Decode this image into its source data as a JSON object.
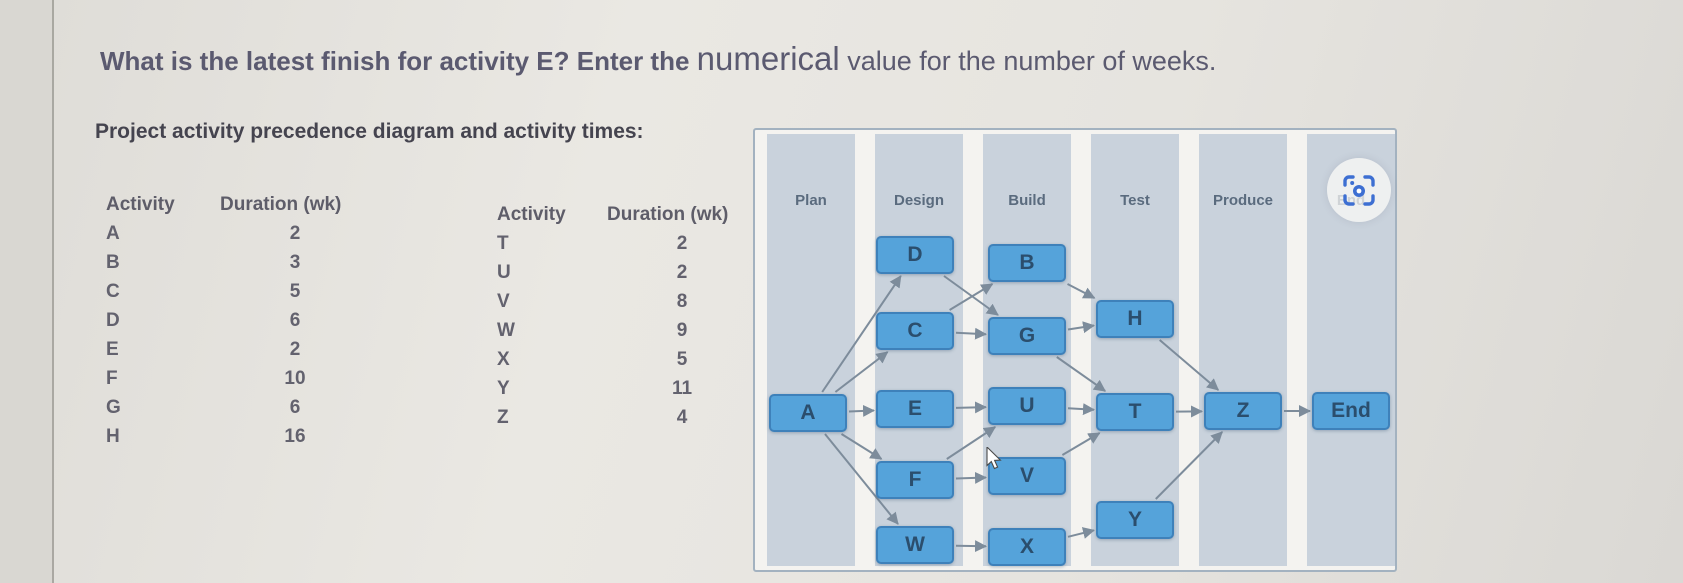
{
  "question": {
    "part1": "What is the latest finish for activity E? Enter the ",
    "emphasis": "numerical",
    "part2": " value for the number of weeks."
  },
  "subtitle": "Project activity precedence diagram and activity times:",
  "activity_tables": [
    {
      "headers": [
        "Activity",
        "Duration (wk)"
      ],
      "rows": [
        {
          "activity": "A",
          "duration": "2"
        },
        {
          "activity": "B",
          "duration": "3"
        },
        {
          "activity": "C",
          "duration": "5"
        },
        {
          "activity": "D",
          "duration": "6"
        },
        {
          "activity": "E",
          "duration": "2"
        },
        {
          "activity": "F",
          "duration": "10"
        },
        {
          "activity": "G",
          "duration": "6"
        },
        {
          "activity": "H",
          "duration": "16"
        }
      ]
    },
    {
      "headers": [
        "Activity",
        "Duration (wk)"
      ],
      "rows": [
        {
          "activity": "T",
          "duration": "2"
        },
        {
          "activity": "U",
          "duration": "2"
        },
        {
          "activity": "V",
          "duration": "8"
        },
        {
          "activity": "W",
          "duration": "9"
        },
        {
          "activity": "X",
          "duration": "5"
        },
        {
          "activity": "Y",
          "duration": "11"
        },
        {
          "activity": "Z",
          "duration": "4"
        }
      ]
    }
  ],
  "diagram": {
    "phases": [
      "Plan",
      "Design",
      "Build",
      "Test",
      "Produce",
      "End"
    ],
    "node_width": 78,
    "node_height": 38,
    "nodes": [
      {
        "id": "A",
        "label": "A",
        "phase": "Plan",
        "x": 53,
        "y": 283
      },
      {
        "id": "D",
        "label": "D",
        "phase": "Design",
        "x": 160,
        "y": 125
      },
      {
        "id": "C",
        "label": "C",
        "phase": "Design",
        "x": 160,
        "y": 201
      },
      {
        "id": "E",
        "label": "E",
        "phase": "Design",
        "x": 160,
        "y": 279
      },
      {
        "id": "F",
        "label": "F",
        "phase": "Design",
        "x": 160,
        "y": 350
      },
      {
        "id": "W",
        "label": "W",
        "phase": "Design",
        "x": 160,
        "y": 415
      },
      {
        "id": "B",
        "label": "B",
        "phase": "Build",
        "x": 272,
        "y": 133
      },
      {
        "id": "G",
        "label": "G",
        "phase": "Build",
        "x": 272,
        "y": 206
      },
      {
        "id": "U",
        "label": "U",
        "phase": "Build",
        "x": 272,
        "y": 276
      },
      {
        "id": "V",
        "label": "V",
        "phase": "Build",
        "x": 272,
        "y": 346
      },
      {
        "id": "X",
        "label": "X",
        "phase": "Build",
        "x": 272,
        "y": 417
      },
      {
        "id": "H",
        "label": "H",
        "phase": "Test",
        "x": 380,
        "y": 189
      },
      {
        "id": "T",
        "label": "T",
        "phase": "Test",
        "x": 380,
        "y": 282
      },
      {
        "id": "Y",
        "label": "Y",
        "phase": "Test",
        "x": 380,
        "y": 390
      },
      {
        "id": "Z",
        "label": "Z",
        "phase": "Produce",
        "x": 488,
        "y": 281
      },
      {
        "id": "End",
        "label": "End",
        "phase": "End",
        "x": 596,
        "y": 281
      }
    ],
    "edges": [
      [
        "A",
        "D"
      ],
      [
        "A",
        "C"
      ],
      [
        "A",
        "E"
      ],
      [
        "A",
        "F"
      ],
      [
        "A",
        "W"
      ],
      [
        "D",
        "G"
      ],
      [
        "C",
        "B"
      ],
      [
        "C",
        "G"
      ],
      [
        "E",
        "U"
      ],
      [
        "F",
        "U"
      ],
      [
        "F",
        "V"
      ],
      [
        "W",
        "X"
      ],
      [
        "B",
        "H"
      ],
      [
        "G",
        "H"
      ],
      [
        "G",
        "T"
      ],
      [
        "U",
        "T"
      ],
      [
        "V",
        "T"
      ],
      [
        "X",
        "Y"
      ],
      [
        "H",
        "Z"
      ],
      [
        "T",
        "Z"
      ],
      [
        "Y",
        "Z"
      ],
      [
        "Z",
        "End"
      ]
    ],
    "colors": {
      "band": "#c9d2dc",
      "panel_bg": "#f4f3f0",
      "panel_border": "#a3b2c0",
      "node_fill": "#55a3da",
      "node_border": "#3e81ba",
      "node_text": "#2b4e6d",
      "edge": "#7d8c9b",
      "header_text": "#5a6b7e"
    }
  },
  "capture_button": {
    "icon_name": "screen-capture-icon",
    "accent": "#3d6fd2"
  },
  "cursor": {
    "x": 988,
    "y": 449
  }
}
